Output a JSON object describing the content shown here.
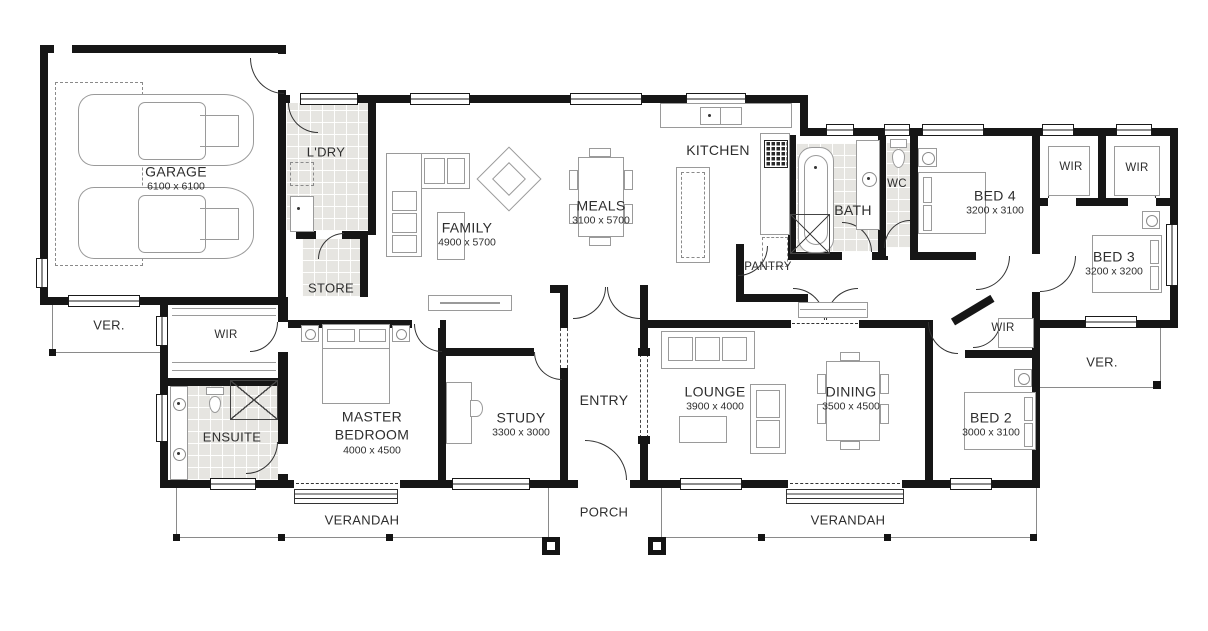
{
  "rooms": {
    "garage": {
      "name": "GARAGE",
      "dims": "6100 x 6100"
    },
    "ldry": {
      "name": "L'DRY"
    },
    "store": {
      "name": "STORE"
    },
    "family": {
      "name": "FAMILY",
      "dims": "4900 x 5700"
    },
    "meals": {
      "name": "MEALS",
      "dims": "3100 x 5700"
    },
    "kitchen": {
      "name": "KITCHEN"
    },
    "pantry": {
      "name": "PANTRY"
    },
    "bath": {
      "name": "BATH"
    },
    "wc": {
      "name": "WC"
    },
    "bed4": {
      "name": "BED 4",
      "dims": "3200 x 3100"
    },
    "wir_bed4": {
      "name": "WIR"
    },
    "wir_bed3": {
      "name": "WIR"
    },
    "bed3": {
      "name": "BED 3",
      "dims": "3200 x 3200"
    },
    "ver_right": {
      "name": "VER."
    },
    "ver_left": {
      "name": "VER."
    },
    "wir_master": {
      "name": "WIR"
    },
    "ensuite": {
      "name": "ENSUITE"
    },
    "master": {
      "name": "MASTER BEDROOM",
      "dims": "4000 x 4500"
    },
    "study": {
      "name": "STUDY",
      "dims": "3300 x 3000"
    },
    "entry": {
      "name": "ENTRY"
    },
    "lounge": {
      "name": "LOUNGE",
      "dims": "3900 x 4000"
    },
    "dining": {
      "name": "DINING",
      "dims": "3500 x 4500"
    },
    "wir_bed2": {
      "name": "WIR"
    },
    "bed2": {
      "name": "BED 2",
      "dims": "3000 x 3100"
    },
    "verandah_left": {
      "name": "VERANDAH"
    },
    "porch": {
      "name": "PORCH"
    },
    "verandah_right": {
      "name": "VERANDAH"
    }
  },
  "colors": {
    "wall": "#161616",
    "tile_floor": "#e6e5e1",
    "furniture_outline": "#9a9a9a",
    "label_text": "#2e2e2e"
  }
}
